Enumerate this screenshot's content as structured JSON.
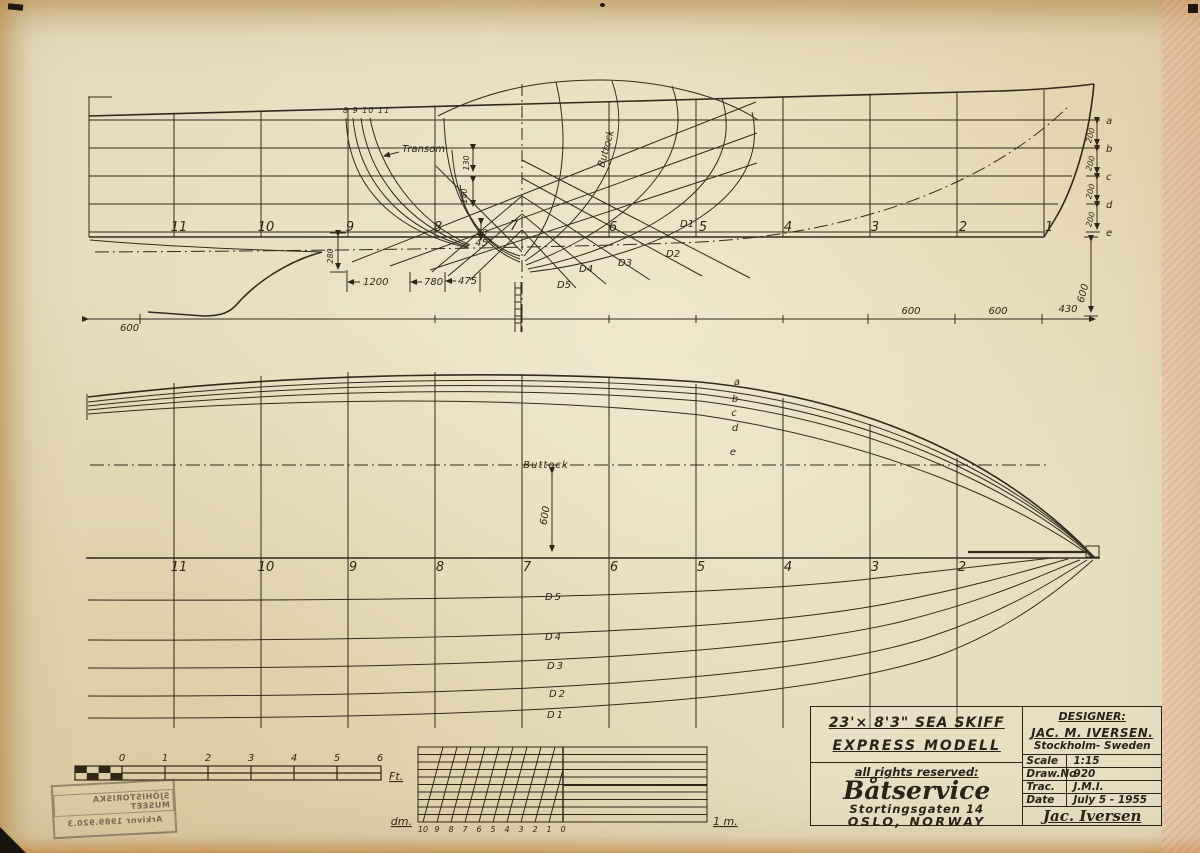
{
  "title_block": {
    "title1": "23'× 8'3\"  SEA SKIFF",
    "title2": "EXPRESS MODELL",
    "rights": "all rights reserved:",
    "firm": "Båtservice",
    "address": "Stortingsgaten 14",
    "city": "OSLO, NORWAY",
    "designer_label": "DESIGNER:",
    "designer_name": "JAC. M. IVERSEN.",
    "designer_city": "Stockholm- Sweden",
    "scale_label": "Scale",
    "scale_value": "1:15",
    "drawno_label": "Draw.No",
    "drawno_value": "920",
    "trac_label": "Trac.",
    "trac_value": "J.M.I.",
    "date_label": "Date",
    "date_value": "July 5 - 1955",
    "signature": "Jac. Iversen"
  },
  "stamp": {
    "line1": "SJÖHISTORISKA MUSEET",
    "line2": "Arkivnr 1989.920.3"
  },
  "profile": {
    "stations": [
      "11",
      "10",
      "9",
      "8",
      "7",
      "6",
      "5",
      "4",
      "3",
      "2",
      "1"
    ],
    "transom_label": "Transom",
    "transom_numbers": "8 9 10 11",
    "buttock_label": "Buttock",
    "angle_label": "45°",
    "waterlines": [
      "a",
      "b",
      "c",
      "d",
      "e"
    ],
    "diagonals": [
      "D1",
      "D2",
      "D3",
      "D4",
      "D5"
    ],
    "dims": {
      "len1200": "1200",
      "len780": "780",
      "len475": "475",
      "h280": "280",
      "h130": "130",
      "h140": "140",
      "h50": "50",
      "w200": "200",
      "v600": "600",
      "base600a": "600",
      "base600b": "600",
      "base600c": "600",
      "base430": "430"
    }
  },
  "plan": {
    "stations": [
      "11",
      "10",
      "9",
      "8",
      "7",
      "6",
      "5",
      "4",
      "3",
      "2"
    ],
    "waterlines": [
      "a",
      "b",
      "c",
      "d",
      "e"
    ],
    "buttock_label": "Buttock",
    "dim600": "600",
    "diagonals": [
      "D5",
      "D4",
      "D3",
      "D2",
      "D1"
    ]
  },
  "scales": {
    "feet": {
      "ticks": [
        "0",
        "1",
        "2",
        "3",
        "4",
        "5",
        "6"
      ],
      "unit": "Ft."
    },
    "metric": {
      "ticks": [
        "10",
        "9",
        "8",
        "7",
        "6",
        "5",
        "4",
        "3",
        "2",
        "1",
        "0"
      ],
      "unit_left": "dm.",
      "unit_right": "1 m."
    }
  },
  "colors": {
    "ink": "#2f2618",
    "paper": "#e6dcbf",
    "tape": "#c08a3c",
    "edge_pink": "#e8a78a"
  }
}
